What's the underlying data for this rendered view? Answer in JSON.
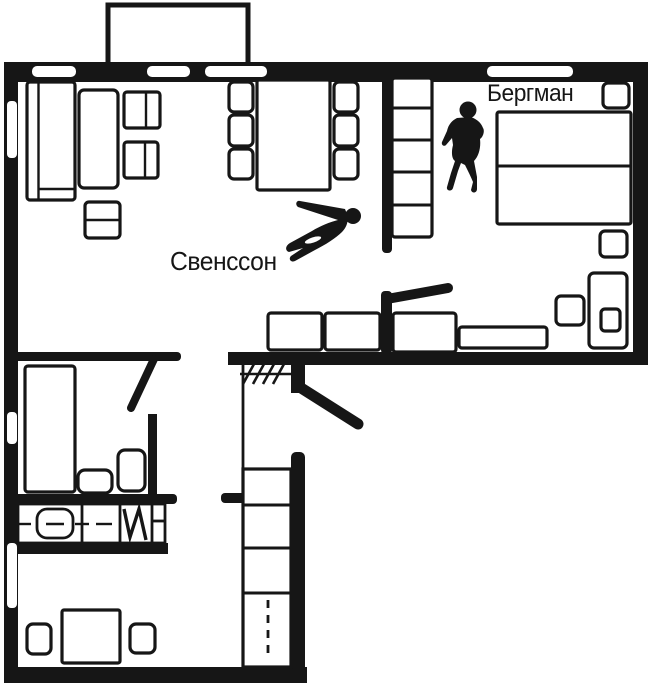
{
  "diagram": {
    "type": "apartment-floor-plan",
    "labels": {
      "bergman": "Бергман",
      "svensson": "Свенссон"
    },
    "colors": {
      "ink": "#161616",
      "paper": "#ffffff"
    },
    "icons": {
      "standing_figure": "standing-person-silhouette",
      "lying_figure": "lying-person-silhouette"
    }
  }
}
